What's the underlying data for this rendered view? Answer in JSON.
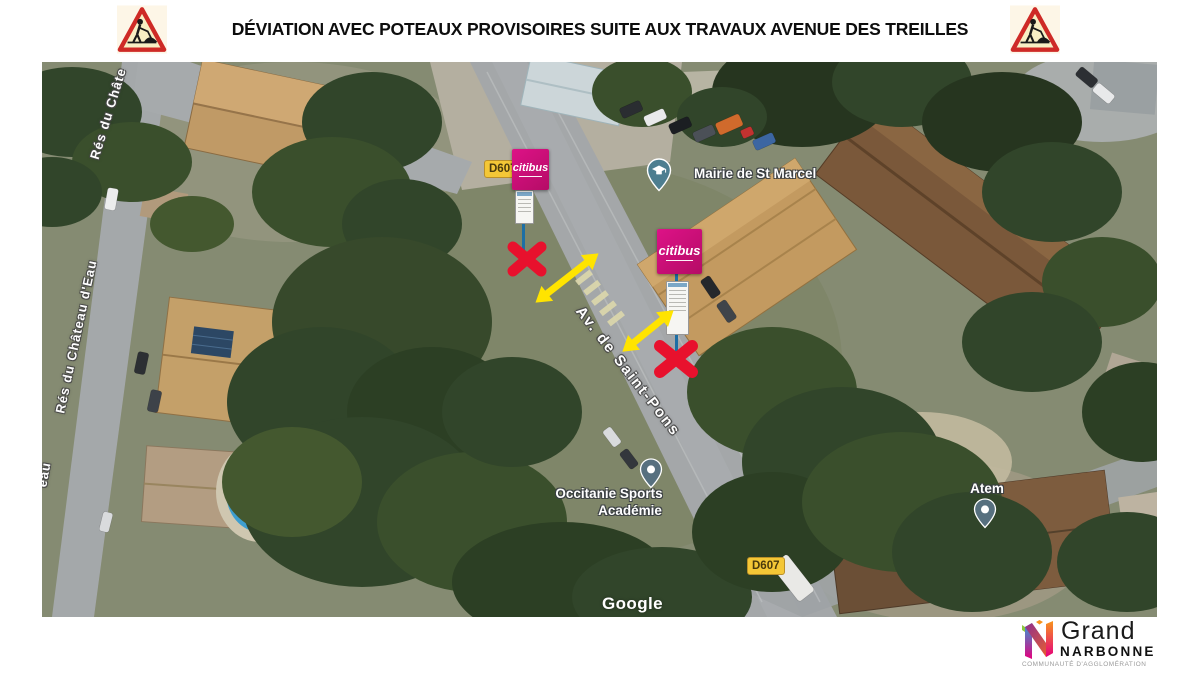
{
  "header": {
    "title": "DÉVIATION AVEC POTEAUX PROVISOIRES SUITE AUX TRAVAUX AVENUE DES TREILLES"
  },
  "map": {
    "streets": {
      "res_du_chate_partial": "Rés du Châte",
      "res_du_chateau_deau": "Rés du Château d'Eau",
      "eau_partial": "eau",
      "av_de_saint_pons": "Av. de Saint-Pons"
    },
    "badges": {
      "d607_top": "D607",
      "d607_bottom": "D607"
    },
    "pois": {
      "mairie": "Mairie de St Marcel",
      "occitanie_line1": "Occitanie Sports",
      "occitanie_line2": "Académie",
      "atem": "Atem"
    },
    "bus_stops": {
      "brand": "citibus"
    },
    "watermark": "Google"
  },
  "footer_logo": {
    "line1": "Grand",
    "line2": "NARBONNE",
    "line3": "COMMUNAUTÉ D'AGGLOMÉRATION"
  },
  "colors": {
    "citibus_magenta": "#cf0f78",
    "badge_yellow": "#f4c736",
    "cross_red": "#e8112d",
    "arrow_yellow": "#ffe400",
    "pole_blue": "#1d6fa5",
    "pin_teal": "#4d7e90",
    "pin_slate": "#57707f"
  }
}
